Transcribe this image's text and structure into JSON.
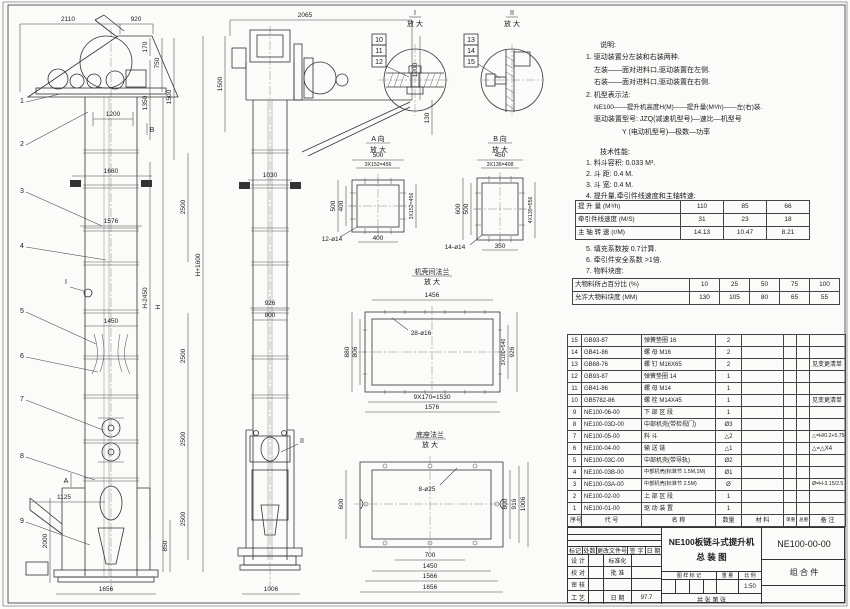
{
  "doc": {
    "type_label": "总装图 (assembly drawing)",
    "sheet_bg": "#fbfbf9",
    "line_color": "#333333"
  },
  "dims": {
    "2110": "2110",
    "920": "920",
    "170": "170",
    "750": "750",
    "1350": "1350",
    "1500": "1500",
    "1200": "1200",
    "1680": "1680",
    "2500": "2500",
    "1576": "1576",
    "1450": "1450",
    "1125": "1125",
    "2000": "2000",
    "850": "850",
    "1656": "1656",
    "h_minus": "H-2450",
    "h": "H",
    "h_plus": "H+1600",
    "2065": "2065",
    "130": "130",
    "1030": "1030",
    "926": "926",
    "800": "800",
    "1006": "1006",
    "500": "500",
    "400": "400",
    "a_pitch": "3X152=456",
    "a_holes": "12-ø14",
    "450": "450",
    "b_pitch": "3X136=408",
    "600": "600",
    "b_side": "4X139=556",
    "350": "350",
    "b_holes": "14-ø14",
    "1456": "1456",
    "880": "880",
    "806": "806",
    "f_pitch_r": "3X180=540",
    "f_pitch_b": "9X170=1530",
    "f_holes": "28-ø16",
    "base_holes": "8-ø25",
    "916": "916",
    "700": "700",
    "1566": "1566"
  },
  "balloons": {
    "n1": "1",
    "n2": "2",
    "n3": "3",
    "n4": "4",
    "n5": "5",
    "n6": "6",
    "n7": "7",
    "n8": "8",
    "n9": "9",
    "n10": "10",
    "n11": "11",
    "n12": "12",
    "n13": "13",
    "n14": "14",
    "n15": "15"
  },
  "labels": {
    "enlarged": "放 大",
    "detail1": "I",
    "detail2": "II",
    "view_a": "A 向",
    "view_b": "B 向",
    "flange": "机壳间法兰",
    "base": "底座法兰",
    "mark_a": "A",
    "mark_b": "B",
    "mark_i": "I",
    "mark_ii": "II"
  },
  "notes": {
    "title": "说明:",
    "l1": "1. 驱动装置分左装和右装两种.",
    "l2": "左装——面对进料口,驱动装置在左侧.",
    "l3": "右装——面对进料口,驱动装置在右侧.",
    "l4": "2. 机型表示法:",
    "l5": "NE100——提升机高度H(M)——提升量(M³/h)——左(右)装.",
    "l6": "驱动装置型号: JZQ(减速机型号)—速比—机型号",
    "l7": "Y (电动机型号)—极数—功率"
  },
  "tech": {
    "title": "技术性能:",
    "l1": "1. 料斗容积: 0.033 M³.",
    "l2": "2. 斗    距: 0.4 M.",
    "l3": "3. 斗    宽: 0.4 M.",
    "l4": "4. 提升量,牵引件线速度和主轴转速:",
    "l5": "5. 填充系数按 0.7计算.",
    "l6": "6. 牵引件安全系数 >1倍.",
    "l7": "7. 物料块度:"
  },
  "perf_table": {
    "r1_label": "提 升 量  (M³/h)",
    "r1": [
      "110",
      "85",
      "66"
    ],
    "r2_label": "牵引件线速度 (M/S)",
    "r2": [
      "31",
      "23",
      "18"
    ],
    "r3_label": "主 轴 转 速  (r/M)",
    "r3": [
      "14.13",
      "10.47",
      "8.21"
    ]
  },
  "size_table": {
    "r1_label": "大物料所占百分比 (%)",
    "r1": [
      "10",
      "25",
      "50",
      "75",
      "100"
    ],
    "r2_label": "允许大物料块度 (MM)",
    "r2": [
      "130",
      "105",
      "80",
      "65",
      "55"
    ]
  },
  "bom": {
    "headers": {
      "no": "序号",
      "code": "代  号",
      "name": "名  称",
      "qty": "数量",
      "mat": "材  料",
      "unit_w": "单重",
      "total_w": "总重",
      "note": "备  注"
    },
    "rows": [
      {
        "no": "15",
        "code": "GB93-87",
        "name": "弹簧垫圈  16",
        "qty": "2",
        "mat": "",
        "note": ""
      },
      {
        "no": "14",
        "code": "GB41-86",
        "name": "螺 母  M16",
        "qty": "2",
        "mat": "",
        "note": ""
      },
      {
        "no": "13",
        "code": "GB68-76",
        "name": "螺 钉  M16X65",
        "qty": "2",
        "mat": "",
        "note": "见变更清单"
      },
      {
        "no": "12",
        "code": "GB93-87",
        "name": "弹簧垫圈  14",
        "qty": "1",
        "mat": "",
        "note": ""
      },
      {
        "no": "11",
        "code": "GB41-86",
        "name": "螺 母  M14",
        "qty": "1",
        "mat": "",
        "note": ""
      },
      {
        "no": "10",
        "code": "GB5782-86",
        "name": "螺 栓  M14X45",
        "qty": "1",
        "mat": "",
        "note": "见变更清单"
      },
      {
        "no": "9",
        "code": "NE100-06-00",
        "name": "下 部 区 段",
        "qty": "1",
        "mat": "",
        "note": ""
      },
      {
        "no": "8",
        "code": "NE100-03D-00",
        "name": "中部机壳(带检视门)",
        "qty": "Ø3",
        "mat": "",
        "note": ""
      },
      {
        "no": "7",
        "code": "NE100-05-00",
        "name": "料  斗",
        "qty": "△2",
        "mat": "",
        "note": "△=H/0.2+5.75"
      },
      {
        "no": "6",
        "code": "NE100-04-00",
        "name": "输 送 链",
        "qty": "△1",
        "mat": "",
        "note": "△=△X4"
      },
      {
        "no": "5",
        "code": "NE100-03C-00",
        "name": "中部机壳(带导轨)",
        "qty": "Ø2",
        "mat": "",
        "note": ""
      },
      {
        "no": "4",
        "code": "NE100-03B-00",
        "name": "中部机壳(标准节 1.5M,1M)",
        "qty": "Ø1",
        "mat": "",
        "note": ""
      },
      {
        "no": "3",
        "code": "NE100-03A-00",
        "name": "中部机壳(标准节 2.5M)",
        "qty": "Ø",
        "mat": "",
        "note": "Ø=H-3.15/2.5"
      },
      {
        "no": "2",
        "code": "NE100-02-00",
        "name": "上 部 区 段",
        "qty": "1",
        "mat": "",
        "note": ""
      },
      {
        "no": "1",
        "code": "NE100-01-00",
        "name": "驱 动 装 置",
        "qty": "1",
        "mat": "",
        "note": ""
      }
    ]
  },
  "titleblock": {
    "title1": "NE100板链斗式提升机",
    "title2": "总  装  图",
    "dwg_no": "NE100-00-00",
    "part_type": "组 合 件",
    "rev_h1": "标记",
    "rev_h2": "处数",
    "rev_h3": "更改文件号",
    "rev_h4": "签 字",
    "rev_h5": "日 期",
    "role1": "设 计",
    "role1b": "标准化",
    "role2": "校 对",
    "role2b": "批 准",
    "role3": "审 核",
    "role3b": "",
    "role4": "工 艺",
    "role4b": "日 期",
    "date": "97.7",
    "mark_label": "图 样 标 记",
    "weight_label": "重 量",
    "scale_label": "比 例",
    "scale": "1:50",
    "sheets": "共    张    第    张"
  }
}
